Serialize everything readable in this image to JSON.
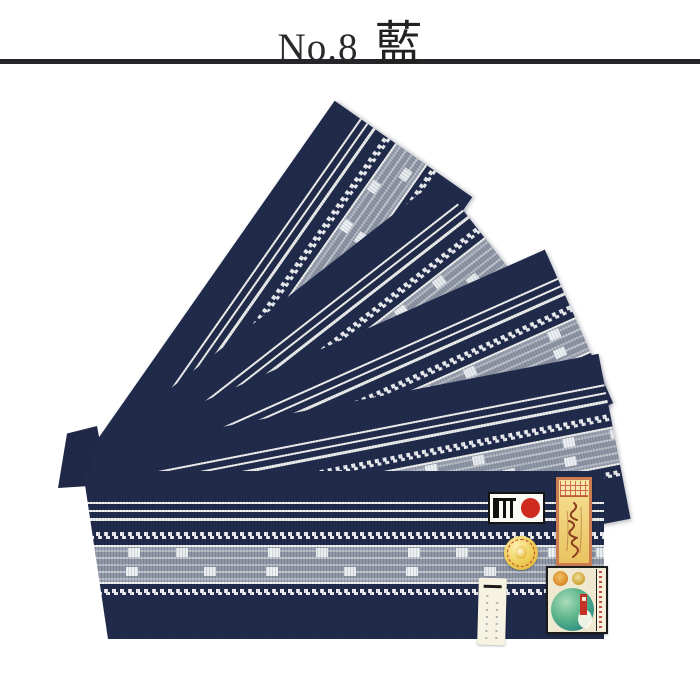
{
  "header": {
    "series_label": "No.8",
    "color_name": "藍",
    "text_color": "#2a2a2a",
    "divider_color": "#26262a"
  },
  "photo": {
    "background": "#ffffff",
    "subject": "five indigo hakata obi belts fanned out with one folded horizontally",
    "belt_count": 5,
    "palette": {
      "navy": "#212b4b",
      "stripe_white": "#f2f3f0",
      "band_gray": "#8f96a6",
      "check_white": "#eef1f4"
    },
    "labels": [
      {
        "name": "maker-seal-label",
        "shape": "rectangle",
        "colors": [
          "#fbfaf4",
          "#141414",
          "#cf2b1e"
        ]
      },
      {
        "name": "orange-tag-label",
        "shape": "vertical-rectangle",
        "colors": [
          "#cd7c51",
          "#f6e096",
          "#8a3c20"
        ]
      },
      {
        "name": "gold-round-sticker",
        "shape": "circle",
        "colors": [
          "#eccb52",
          "#c0392b"
        ]
      },
      {
        "name": "green-emblem-label",
        "shape": "rectangle",
        "colors": [
          "#efe8d0",
          "#2f8e85",
          "#c53127"
        ]
      },
      {
        "name": "paper-tag",
        "shape": "vertical-rectangle",
        "colors": [
          "#f7f3e3",
          "#1a1a1a"
        ]
      }
    ]
  }
}
